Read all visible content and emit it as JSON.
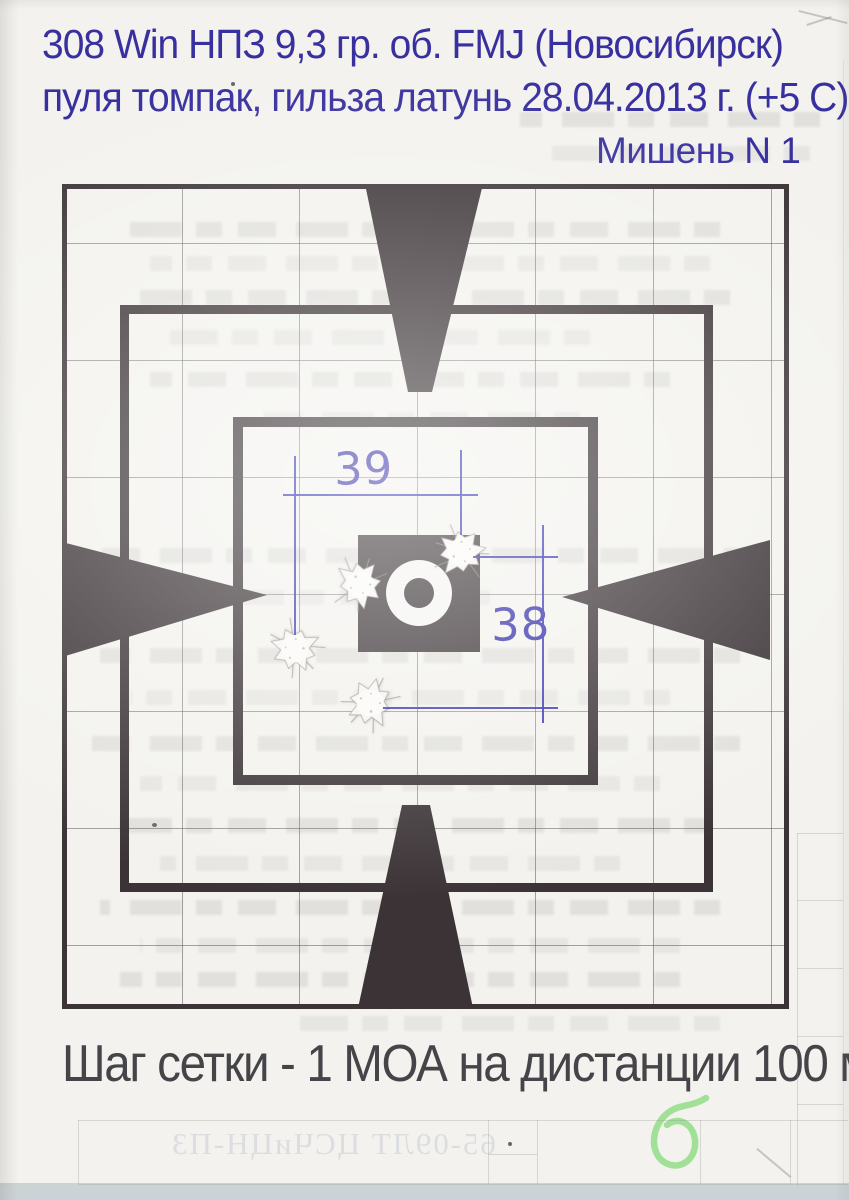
{
  "header": {
    "line1": "308 Win  НПЗ 9,3 гр. об. FMJ (Новосибирск)",
    "line2": "пуля томпак, гильза латунь  28.04.2013 г. (+5 С)",
    "target_label": "Мишень N 1"
  },
  "measurements": {
    "horizontal_spread": "39",
    "vertical_spread": "38"
  },
  "caption": "Шаг сетки - 1 МОА на дистанции 100 м",
  "shots": {
    "count": 4,
    "holes": [
      {
        "x": 461,
        "y": 552
      },
      {
        "x": 360,
        "y": 584
      },
      {
        "x": 295,
        "y": 649
      },
      {
        "x": 370,
        "y": 703
      }
    ]
  },
  "bleedthrough": {
    "doc_number": "65-09ЛТ  ЦСЧиЦН-ПЗ"
  },
  "icons": {
    "green_mark": "handwritten-green-loop",
    "aiming_marks": "four-wedges-pointing-center",
    "bullseye": "square-with-white-ring"
  },
  "colors": {
    "ink_blue": "#38309f",
    "pen_blue": "#2d2ab0",
    "target_dark": "#3b3336",
    "caption_gray": "#454448",
    "marker_green": "#8ede85",
    "paper": "#f3f2ee"
  }
}
